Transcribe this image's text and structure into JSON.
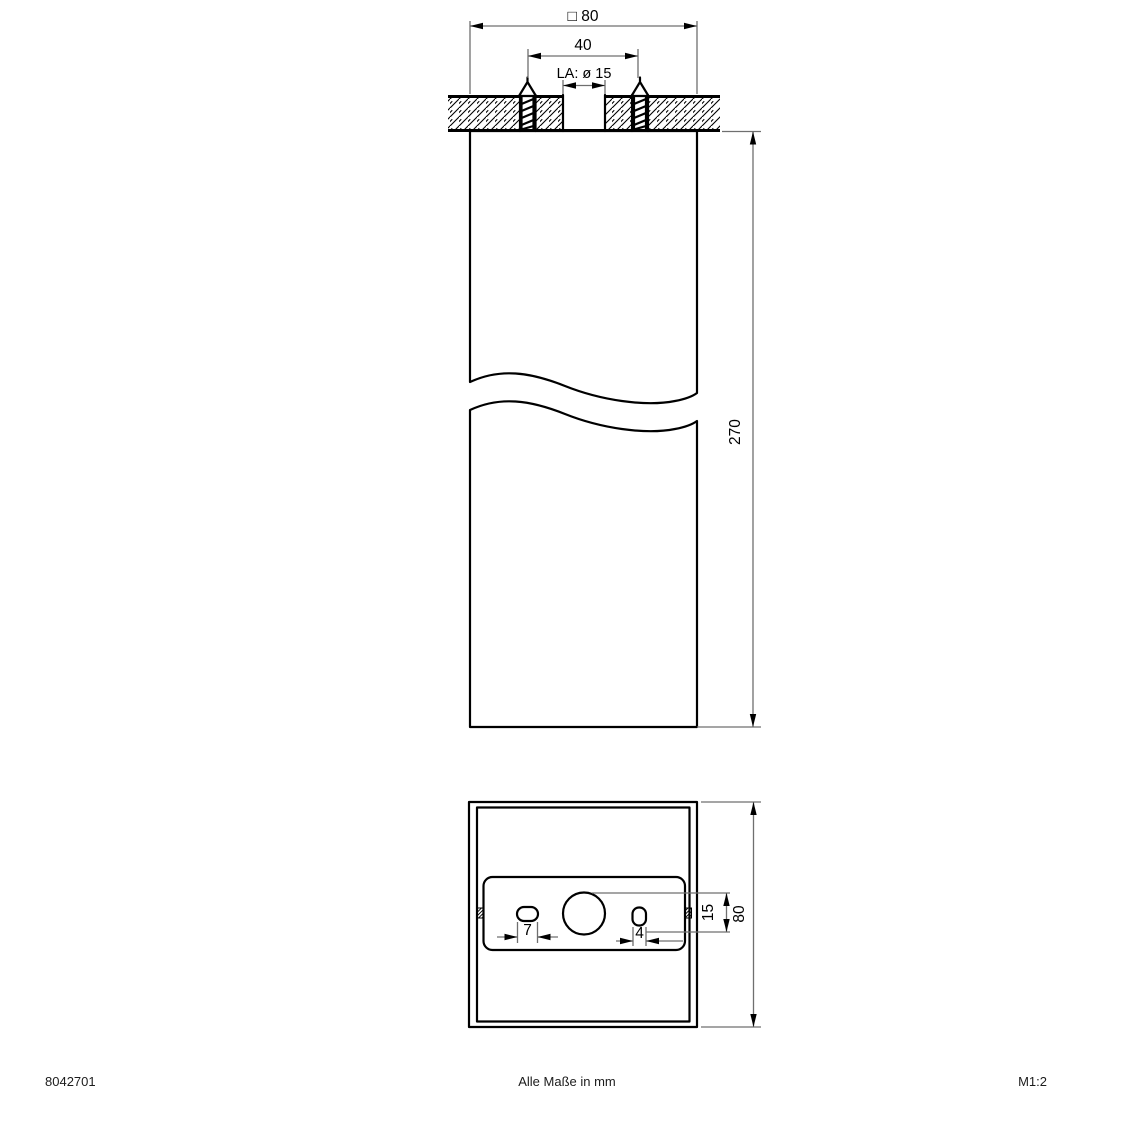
{
  "section_view": {
    "overall_width": "□ 80",
    "screw_spacing": "40",
    "cutout_label": "LA: ø 15",
    "body_height": "270"
  },
  "bottom_view": {
    "slot_left_width": "7",
    "slot_right_width": "4",
    "cutout_diameter": "15",
    "body_width": "80"
  },
  "footer": {
    "article_number": "8042701",
    "note": "Alle Maße in mm",
    "scale": "M1:2"
  },
  "colors": {
    "line": "#000000",
    "dim": "#6f6f6f",
    "background": "#ffffff"
  }
}
